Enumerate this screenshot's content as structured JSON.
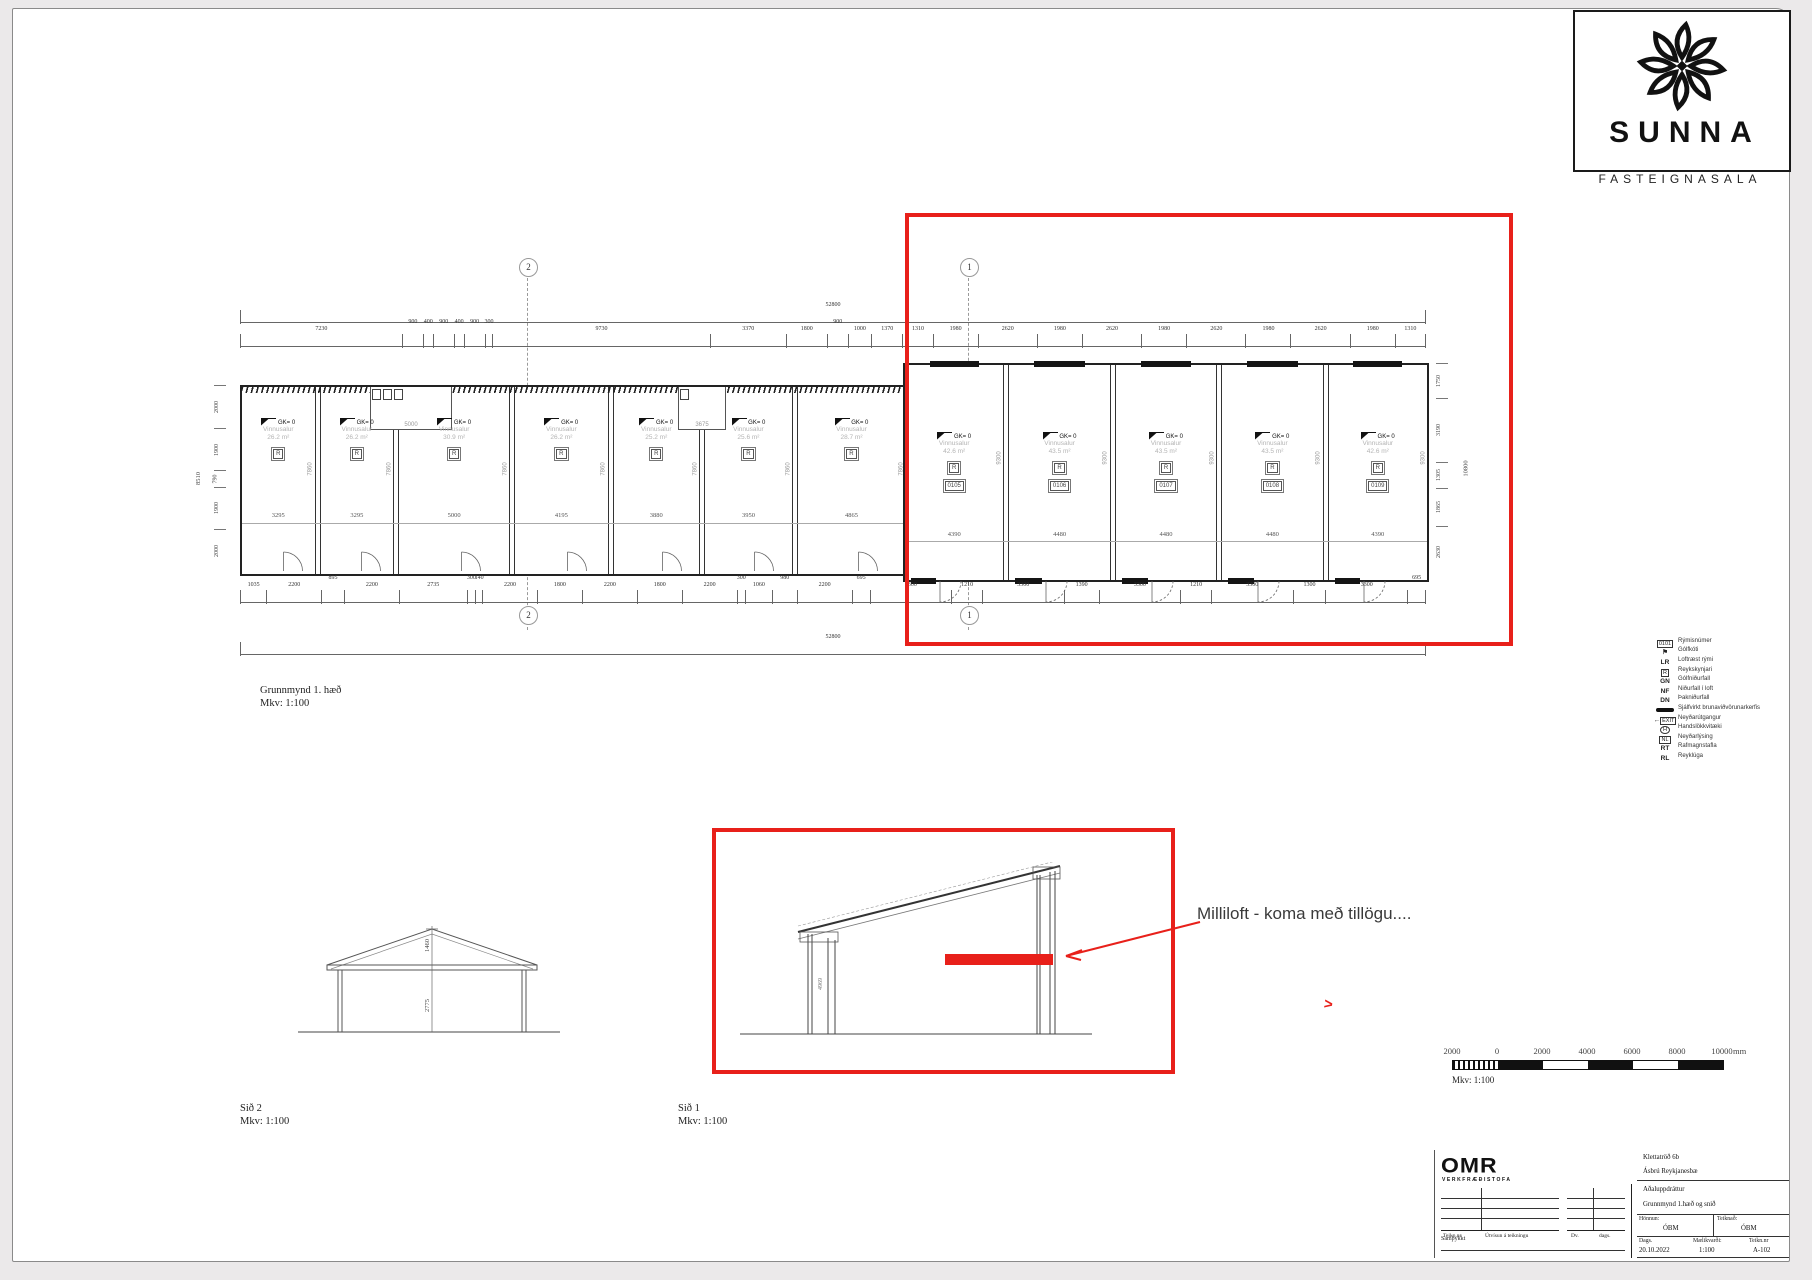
{
  "logo": {
    "name": "SUNNA",
    "sub": "FASTEIGNASALA"
  },
  "plan": {
    "label": "Grunnmynd 1. hæð",
    "scale": "Mkv: 1:100",
    "overall": "52800",
    "level": "GK= 0",
    "room_suffix": "m²",
    "bubble_left": "2",
    "bubble_right": "1",
    "top_dims": [
      "7230",
      "900",
      "400",
      "900",
      "400",
      "900",
      "300",
      "9730",
      "3370",
      "1800",
      "900",
      "1000",
      "1370",
      "1310",
      "1980",
      "2620",
      "1980",
      "2620",
      "1980",
      "2620",
      "1980",
      "2620",
      "1980",
      "1310"
    ],
    "bottom_dims": [
      "1035",
      "2200",
      "895",
      "2200",
      "2735",
      "300",
      "140",
      "2200",
      "1800",
      "2200",
      "1800",
      "2200",
      "300",
      "1060",
      "980",
      "2200",
      "695",
      "3300",
      "1210",
      "3300",
      "1390",
      "3300",
      "1210",
      "3300",
      "1300",
      "3300",
      "695"
    ],
    "left_dims": [
      "2000",
      "1900",
      "790",
      "1900",
      "2000"
    ],
    "left_overall": "8510",
    "right_dims": [
      "1750",
      "3190",
      "1305",
      "1865",
      "2630"
    ],
    "right_overall": "10800",
    "wc_dims": [
      "5000",
      "3675"
    ],
    "detector_symbol": "R",
    "units_left": [
      {
        "name": "Vinnusalur",
        "area": "26.2",
        "width": "3295",
        "depth": "7860"
      },
      {
        "name": "Vinnusalur",
        "area": "26.2",
        "width": "3295",
        "depth": "7860"
      },
      {
        "name": "Vinnusalur",
        "area": "30.9",
        "width": "5000",
        "depth": "7860"
      },
      {
        "name": "Vinnusalur",
        "area": "26.2",
        "width": "4195",
        "depth": "7860"
      },
      {
        "name": "Vinnusalur",
        "area": "25.2",
        "width": "3880",
        "depth": "7860"
      },
      {
        "name": "Vinnusalur",
        "area": "25.6",
        "width": "3950",
        "depth": "7860"
      },
      {
        "name": "Vinnusalur",
        "area": "28.7",
        "width": "4865",
        "depth": "7860"
      }
    ],
    "units_right": [
      {
        "num": "0105",
        "name": "Vinnusalur",
        "area": "42.6",
        "width": "4390",
        "depth": "9300"
      },
      {
        "num": "0106",
        "name": "Vinnusalur",
        "area": "43.5",
        "width": "4480",
        "depth": "9300"
      },
      {
        "num": "0107",
        "name": "Vinnusalur",
        "area": "43.5",
        "width": "4480",
        "depth": "9300"
      },
      {
        "num": "0108",
        "name": "Vinnusalur",
        "area": "43.5",
        "width": "4480",
        "depth": "9300"
      },
      {
        "num": "0109",
        "name": "Vinnusalur",
        "area": "42.6",
        "width": "4390",
        "depth": "9300"
      }
    ]
  },
  "legend": {
    "rows": [
      {
        "sym": "0101",
        "type": "box",
        "label": "Rýmisnúmer"
      },
      {
        "sym": "⚑",
        "type": "flag",
        "label": "Gólfkóti"
      },
      {
        "sym": "LR",
        "type": "text",
        "label": "Loftræst rými"
      },
      {
        "sym": "R",
        "type": "box",
        "label": "Reykskynjari"
      },
      {
        "sym": "GN",
        "type": "text",
        "label": "Gólfniðurfall"
      },
      {
        "sym": "NF",
        "type": "text",
        "label": "Niðurfall í loft"
      },
      {
        "sym": "DN",
        "type": "text",
        "label": "Þakniðurfall"
      },
      {
        "sym": "",
        "type": "bar",
        "label": "Sjálfvirkt brunaviðvörunarkerfis"
      },
      {
        "sym": "EXIT",
        "type": "exit",
        "label": "Neyðarútgangur"
      },
      {
        "sym": "H",
        "type": "oval",
        "label": "Handslökkvitæki"
      },
      {
        "sym": "NL",
        "type": "box",
        "label": "Neyðarlýsing"
      },
      {
        "sym": "RT",
        "type": "text",
        "label": "Rafmagnstafla"
      },
      {
        "sym": "RL",
        "type": "text",
        "label": "Reyklúga"
      }
    ]
  },
  "sections": {
    "s2": {
      "label": "Sið 2",
      "scale": "Mkv: 1:100",
      "dim_roof": "1460",
      "dim_wall": "2775"
    },
    "s1": {
      "label": "Sið 1",
      "scale": "Mkv: 1:100",
      "dim_wall": "4969"
    }
  },
  "annotation": {
    "text": "Milliloft - koma með tillögu....",
    "chevron": ">"
  },
  "scalebar": {
    "ticks": [
      "2000",
      "0",
      "2000",
      "4000",
      "6000",
      "8000",
      "10000"
    ],
    "unit": "mm",
    "scale": "Mkv: 1:100"
  },
  "titleblock": {
    "firm": "OMR",
    "firm_sub": "VERKFRÆÐISTOFA",
    "col_teikn": "Teikn.nr",
    "col_utv": "Útvísun á teikningu",
    "col_dv": "Dv.",
    "col_dags": "dags.",
    "approved_label": "Samþykkt",
    "project": "Klettatröð 6b",
    "location": "Ásbrú Reykjanesbæ",
    "doc_type": "Aðaluppdráttur",
    "sheet_title": "Grunnmynd 1.hæð og snið",
    "design_label": "Hönnun:",
    "design": "ÓBM",
    "drawn_label": "Teiknað:",
    "drawn": "ÓBM",
    "date_label": "Dags.",
    "date": "20.10.2022",
    "scale_label": "Mælikvarði:",
    "scale": "1:100",
    "number_label": "Teikn.nr",
    "number": "A-102"
  },
  "colors": {
    "red": "#e8201a"
  }
}
